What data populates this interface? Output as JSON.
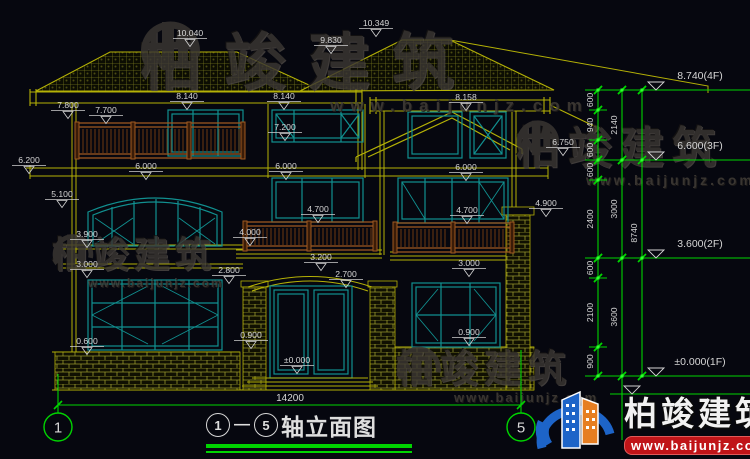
{
  "page": {
    "background": "#06070f"
  },
  "watermark": {
    "brand": "柏竣建筑",
    "site": "www.baijunjz.com"
  },
  "logo": {
    "brand": "柏竣建筑",
    "site": "www.baijunjz.com"
  },
  "title": {
    "axis_start": "1",
    "axis_end": "5",
    "text": "轴立面图"
  },
  "axis_bubbles": {
    "left": "1",
    "right": "5"
  },
  "bottom_dim": {
    "t": "14200",
    "x": 290,
    "y": 401
  },
  "colors": {
    "cad_yellow": "#b4b106",
    "cad_teal": "#119090",
    "cad_brown": "#8a4a16",
    "cad_green": "#00d400",
    "label_white": "#d6d6d6",
    "logo_blue": "#1d64c8",
    "logo_orange": "#e67e22",
    "logo_red": "#c01418"
  },
  "elevation_labels": [
    {
      "t": "10.040",
      "x": 190,
      "y": 36
    },
    {
      "t": "9.830",
      "x": 331,
      "y": 43
    },
    {
      "t": "10.349",
      "x": 376,
      "y": 26
    },
    {
      "t": "8.140",
      "x": 187,
      "y": 99
    },
    {
      "t": "8.140",
      "x": 284,
      "y": 99
    },
    {
      "t": "8.158",
      "x": 466,
      "y": 100
    },
    {
      "t": "7.800",
      "x": 68,
      "y": 108
    },
    {
      "t": "7.700",
      "x": 106,
      "y": 113
    },
    {
      "t": "7.200",
      "x": 285,
      "y": 130
    },
    {
      "t": "6.750",
      "x": 563,
      "y": 145
    },
    {
      "t": "6.200",
      "x": 29,
      "y": 163
    },
    {
      "t": "6.000",
      "x": 146,
      "y": 169
    },
    {
      "t": "6.000",
      "x": 286,
      "y": 169
    },
    {
      "t": "6.000",
      "x": 466,
      "y": 170
    },
    {
      "t": "5.100",
      "x": 62,
      "y": 197
    },
    {
      "t": "4.700",
      "x": 318,
      "y": 212
    },
    {
      "t": "4.700",
      "x": 467,
      "y": 213
    },
    {
      "t": "4.900",
      "x": 546,
      "y": 206
    },
    {
      "t": "3.900",
      "x": 87,
      "y": 237
    },
    {
      "t": "4.000",
      "x": 250,
      "y": 235
    },
    {
      "t": "3.200",
      "x": 321,
      "y": 260
    },
    {
      "t": "3.000",
      "x": 87,
      "y": 267
    },
    {
      "t": "2.800",
      "x": 229,
      "y": 273
    },
    {
      "t": "2.700",
      "x": 346,
      "y": 277
    },
    {
      "t": "3.000",
      "x": 469,
      "y": 266
    },
    {
      "t": "0.900",
      "x": 251,
      "y": 338
    },
    {
      "t": "0.900",
      "x": 469,
      "y": 335
    },
    {
      "t": "0.600",
      "x": 87,
      "y": 344
    },
    {
      "t": "±0.000",
      "x": 297,
      "y": 363
    }
  ],
  "right_dims": {
    "verticals": [
      598,
      622,
      642
    ],
    "levels": [
      {
        "label": "8.740(4F)",
        "y": 90
      },
      {
        "label": "6.600(3F)",
        "y": 160
      },
      {
        "label": "3.600(2F)",
        "y": 258
      },
      {
        "label": "±0.000(1F)",
        "y": 376
      }
    ],
    "col1": [
      {
        "t": "600",
        "y1": 90,
        "y2": 110
      },
      {
        "t": "940",
        "y1": 110,
        "y2": 140
      },
      {
        "t": "600",
        "y1": 140,
        "y2": 160
      },
      {
        "t": "600",
        "y1": 160,
        "y2": 180
      },
      {
        "t": "2400",
        "y1": 180,
        "y2": 258
      },
      {
        "t": "600",
        "y1": 258,
        "y2": 278
      },
      {
        "t": "2100",
        "y1": 278,
        "y2": 347
      },
      {
        "t": "900",
        "y1": 347,
        "y2": 376
      }
    ],
    "col2": [
      {
        "t": "2140",
        "y1": 90,
        "y2": 160
      },
      {
        "t": "3000",
        "y1": 160,
        "y2": 258
      },
      {
        "t": "3600",
        "y1": 258,
        "y2": 376
      }
    ],
    "col3": [
      {
        "t": "8740",
        "y1": 90,
        "y2": 376
      }
    ]
  }
}
